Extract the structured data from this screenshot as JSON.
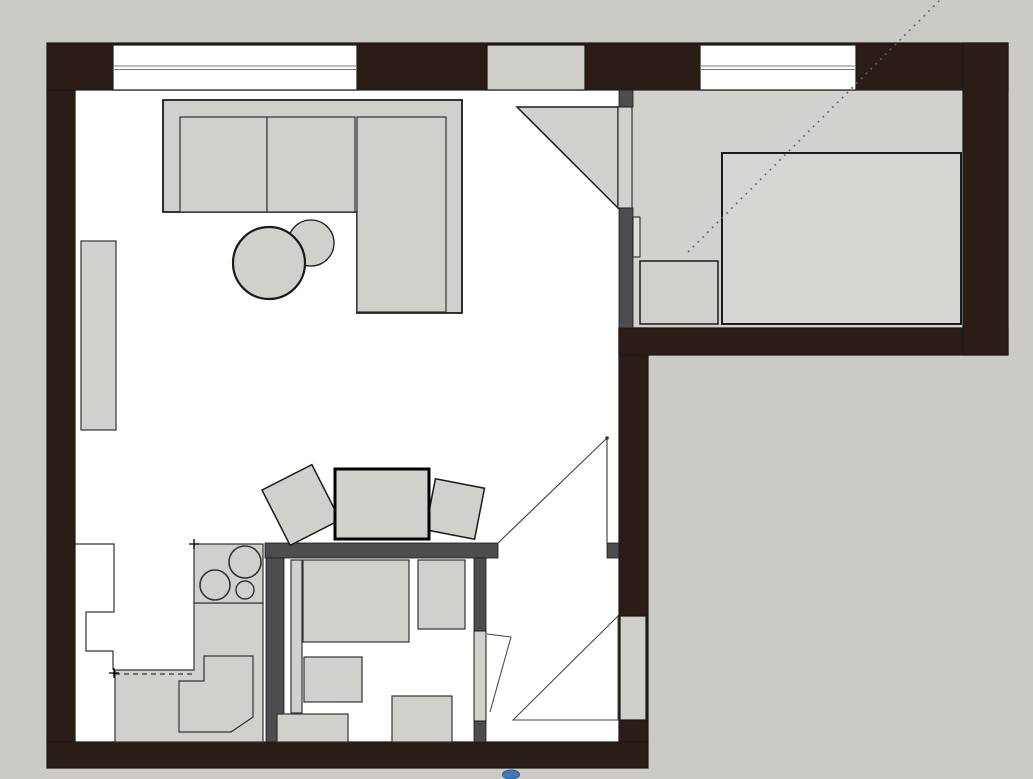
{
  "app": {
    "title": "apartment-floor-plan",
    "canvas": {
      "width": 1033,
      "height": 779
    }
  },
  "palette": {
    "outside": "#cbcac5",
    "floor": "#ffffff",
    "room_gray": "#d2d1cd",
    "furniture": "#d2d0cc",
    "bed": "#d6d5d1",
    "leaf": "#d2d1cd",
    "block": "#d0cfca",
    "fixture": "#dededa",
    "wall": "#2a1d18",
    "partition": "#4d4d4f",
    "line": "#1a1a1a",
    "thin": "#333333",
    "swing": "#4a4a4a",
    "glass_line": "#7a7a7a",
    "dotted": "#5f5f96",
    "black": "#000000",
    "blue": "#4179b5",
    "blue_edge": "#2d5a8a",
    "none": "none"
  },
  "shapes": [
    {
      "name": "outside-ground",
      "type": "rect",
      "x": 0,
      "y": 0,
      "w": 1033,
      "h": 779,
      "fill": "outside"
    },
    {
      "name": "main-floor",
      "type": "rect",
      "x": 75,
      "y": 90,
      "w": 544,
      "h": 652,
      "fill": "floor"
    },
    {
      "name": "bedroom-floor",
      "type": "rect",
      "x": 633,
      "y": 90,
      "w": 330,
      "h": 238,
      "fill": "room_gray"
    },
    {
      "name": "top-exterior-wall",
      "type": "rect",
      "x": 47,
      "y": 43,
      "w": 961,
      "h": 47,
      "fill": "wall",
      "stroke": "line",
      "sw": 1.2
    },
    {
      "name": "left-exterior-wall",
      "type": "rect",
      "x": 47,
      "y": 90,
      "w": 28,
      "h": 652,
      "fill": "wall",
      "stroke": "line",
      "sw": 1.2
    },
    {
      "name": "bottom-exterior-wall",
      "type": "rect",
      "x": 47,
      "y": 742,
      "w": 601,
      "h": 26,
      "fill": "wall",
      "stroke": "line",
      "sw": 1.2
    },
    {
      "name": "hall-right-exterior-wall",
      "type": "rect",
      "x": 619,
      "y": 328,
      "w": 29,
      "h": 414,
      "fill": "wall",
      "stroke": "line",
      "sw": 1.2
    },
    {
      "name": "bedroom-bottom-exterior-wall",
      "type": "rect",
      "x": 619,
      "y": 328,
      "w": 389,
      "h": 27,
      "fill": "wall",
      "stroke": "line",
      "sw": 1.2
    },
    {
      "name": "right-exterior-wall",
      "type": "rect",
      "x": 963,
      "y": 43,
      "w": 45,
      "h": 312,
      "fill": "wall",
      "stroke": "line",
      "sw": 1.2
    },
    {
      "name": "living-room-window",
      "type": "rect",
      "x": 113,
      "y": 45,
      "w": 244,
      "h": 45,
      "fill": "floor",
      "stroke": "line",
      "sw": 1.2
    },
    {
      "name": "living-room-window-glass-line-1",
      "type": "line",
      "x1": 113,
      "y1": 66,
      "x2": 357,
      "y2": 66,
      "stroke": "glass_line",
      "sw": 1
    },
    {
      "name": "living-room-window-glass-line-2",
      "type": "line",
      "x1": 113,
      "y1": 69.5,
      "x2": 357,
      "y2": 69.5,
      "stroke": "glass_line",
      "sw": 1
    },
    {
      "name": "wall-infill-block",
      "type": "rect",
      "x": 487,
      "y": 45,
      "w": 98,
      "h": 45,
      "fill": "block",
      "stroke": "line",
      "sw": 1.2
    },
    {
      "name": "bedroom-window",
      "type": "rect",
      "x": 700,
      "y": 45,
      "w": 156,
      "h": 45,
      "fill": "floor",
      "stroke": "line",
      "sw": 1.2
    },
    {
      "name": "bedroom-window-glass-line-1",
      "type": "line",
      "x1": 700,
      "y1": 66,
      "x2": 856,
      "y2": 66,
      "stroke": "glass_line",
      "sw": 1
    },
    {
      "name": "bedroom-window-glass-line-2",
      "type": "line",
      "x1": 700,
      "y1": 69.5,
      "x2": 856,
      "y2": 69.5,
      "stroke": "glass_line",
      "sw": 1
    },
    {
      "name": "left-wall-joint-line",
      "type": "line",
      "x1": 47,
      "y1": 544,
      "x2": 75,
      "y2": 544,
      "stroke": "line",
      "sw": 1
    },
    {
      "name": "hall-wall-joint-line",
      "type": "line",
      "x1": 619,
      "y1": 355,
      "x2": 648,
      "y2": 355,
      "stroke": "line",
      "sw": 1
    },
    {
      "name": "hall-partition-band",
      "type": "rect",
      "x": 265,
      "y": 543,
      "w": 233,
      "h": 15,
      "fill": "partition",
      "stroke": "line",
      "sw": 0.8
    },
    {
      "name": "hall-opening-stub",
      "type": "rect",
      "x": 607,
      "y": 543,
      "w": 12,
      "h": 15,
      "fill": "partition",
      "stroke": "line",
      "sw": 0.8
    },
    {
      "name": "kitchen-bathroom-partition",
      "type": "rect",
      "x": 266,
      "y": 558,
      "w": 18,
      "h": 184,
      "fill": "partition",
      "stroke": "line",
      "sw": 0.8
    },
    {
      "name": "bathroom-right-wall-upper",
      "type": "rect",
      "x": 474,
      "y": 558,
      "w": 12,
      "h": 73,
      "fill": "partition",
      "stroke": "line",
      "sw": 0.8
    },
    {
      "name": "bathroom-right-wall-stub",
      "type": "rect",
      "x": 474,
      "y": 721,
      "w": 12,
      "h": 21,
      "fill": "partition",
      "stroke": "line",
      "sw": 0.8
    },
    {
      "name": "bedroom-partition-stub",
      "type": "rect",
      "x": 619,
      "y": 90,
      "w": 14,
      "h": 17,
      "fill": "partition",
      "stroke": "line",
      "sw": 0.8
    },
    {
      "name": "bedroom-partition-wall",
      "type": "rect",
      "x": 619,
      "y": 208,
      "w": 14,
      "h": 120,
      "fill": "partition",
      "stroke": "line",
      "sw": 0.8
    },
    {
      "name": "bedroom-door-swing",
      "type": "polygon",
      "points": "517,107 618,107 618,208",
      "fill": "room_gray",
      "stroke": "line",
      "sw": 1.5
    },
    {
      "name": "bedroom-door-leaf",
      "type": "rect",
      "x": 618,
      "y": 107,
      "w": 14,
      "h": 101,
      "fill": "leaf",
      "stroke": "line",
      "sw": 1
    },
    {
      "name": "bedroom-wall-fixture",
      "type": "rect",
      "x": 633,
      "y": 217,
      "w": 7,
      "h": 40,
      "fill": "fixture",
      "stroke": "line",
      "sw": 1
    },
    {
      "name": "bed",
      "type": "rect",
      "x": 722,
      "y": 153,
      "w": 239,
      "h": 171,
      "fill": "bed",
      "stroke": "line",
      "sw": 2
    },
    {
      "name": "nightstand",
      "type": "rect",
      "x": 640,
      "y": 261,
      "w": 78,
      "h": 63,
      "fill": "furniture",
      "stroke": "line",
      "sw": 1.5
    },
    {
      "name": "sofa-frame",
      "type": "polygon",
      "points": "163,100 462,100 462,313 357,313 357,212 163,212",
      "fill": "furniture",
      "stroke": "line",
      "sw": 1.8
    },
    {
      "name": "sofa-cushion-left",
      "type": "rect",
      "x": 180,
      "y": 117,
      "w": 87,
      "h": 95,
      "fill": "furniture",
      "stroke": "thin",
      "sw": 1.2
    },
    {
      "name": "sofa-cushion-right",
      "type": "rect",
      "x": 267,
      "y": 117,
      "w": 88,
      "h": 95,
      "fill": "furniture",
      "stroke": "thin",
      "sw": 1.2
    },
    {
      "name": "sofa-chaise-cushion",
      "type": "rect",
      "x": 357,
      "y": 117,
      "w": 89,
      "h": 195,
      "fill": "furniture",
      "stroke": "thin",
      "sw": 1.2
    },
    {
      "name": "side-table",
      "type": "circle",
      "cx": 311,
      "cy": 243,
      "r": 23,
      "fill": "furniture",
      "stroke": "line",
      "sw": 1.3
    },
    {
      "name": "coffee-table",
      "type": "circle",
      "cx": 269,
      "cy": 263,
      "r": 36,
      "fill": "furniture",
      "stroke": "line",
      "sw": 2.2
    },
    {
      "name": "wall-shelf",
      "type": "rect",
      "x": 81,
      "y": 241,
      "w": 35,
      "h": 189,
      "fill": "furniture",
      "stroke": "thin",
      "sw": 1.2
    },
    {
      "name": "dining-chair-left",
      "type": "rect",
      "x": 273,
      "y": 474,
      "w": 56,
      "h": 62,
      "rot": -27,
      "fill": "furniture",
      "stroke": "line",
      "sw": 1.5
    },
    {
      "name": "dining-chair-right",
      "type": "rect",
      "x": 430,
      "y": 483,
      "w": 50,
      "h": 52,
      "rot": 11,
      "fill": "furniture",
      "stroke": "line",
      "sw": 1.5
    },
    {
      "name": "dining-table",
      "type": "rect",
      "x": 335,
      "y": 469,
      "w": 94,
      "h": 70,
      "fill": "furniture",
      "stroke": "black",
      "sw": 3
    },
    {
      "name": "kitchen-tall-unit-outline",
      "type": "path",
      "d": "M75,544 L114,544 L114,612 L86,612 L86,651 L113,651 L113,670",
      "fill": "none",
      "stroke": "thin",
      "sw": 1.2
    },
    {
      "name": "kitchen-counter",
      "type": "polygon",
      "points": "194,603 263,603 263,742 115,742 115,670 194,670",
      "fill": "furniture",
      "stroke": "thin",
      "sw": 1.2
    },
    {
      "name": "cooktop",
      "type": "rect",
      "x": 194,
      "y": 544,
      "w": 69,
      "h": 59,
      "fill": "furniture",
      "stroke": "thin",
      "sw": 1.2
    },
    {
      "name": "burner-large",
      "type": "circle",
      "cx": 245,
      "cy": 562,
      "r": 16,
      "fill": "furniture",
      "stroke": "thin",
      "sw": 1.6
    },
    {
      "name": "burner-medium",
      "type": "circle",
      "cx": 215,
      "cy": 585,
      "r": 15,
      "fill": "furniture",
      "stroke": "thin",
      "sw": 1.6
    },
    {
      "name": "burner-small",
      "type": "circle",
      "cx": 245,
      "cy": 590,
      "r": 9,
      "fill": "furniture",
      "stroke": "thin",
      "sw": 1.4
    },
    {
      "name": "kitchen-sink-unit",
      "type": "polygon",
      "points": "204,656 253,656 253,717 231,732 179,732 179,681 204,681",
      "fill": "furniture",
      "stroke": "thin",
      "sw": 1.2
    },
    {
      "name": "upper-cabinet-dashed-line",
      "type": "line",
      "x1": 115,
      "y1": 674,
      "x2": 193,
      "y2": 674,
      "stroke": "thin",
      "sw": 1.2,
      "dash": "5 4"
    },
    {
      "name": "reference-cross-left",
      "type": "path",
      "d": "M109,673 L119,673 M114,668 L114,678",
      "fill": "none",
      "stroke": "black",
      "sw": 1.3
    },
    {
      "name": "reference-cross-right",
      "type": "path",
      "d": "M189,544 L199,544 M194,539 L194,549",
      "fill": "none",
      "stroke": "black",
      "sw": 1.3
    },
    {
      "name": "hall-door-swing-hypotenuse",
      "type": "line",
      "x1": 498,
      "y1": 543,
      "x2": 607,
      "y2": 438,
      "stroke": "swing",
      "sw": 1.2
    },
    {
      "name": "hall-door-open-leaf-line",
      "type": "line",
      "x1": 607,
      "y1": 438,
      "x2": 607,
      "y2": 543,
      "stroke": "swing",
      "sw": 1.2
    },
    {
      "name": "hall-door-hinge-dot",
      "type": "circle",
      "cx": 607,
      "cy": 438,
      "r": 1.8,
      "fill": "thin"
    },
    {
      "name": "bathroom-pipe-chase",
      "type": "rect",
      "x": 291,
      "y": 560,
      "w": 11,
      "h": 153,
      "fill": "furniture",
      "stroke": "thin",
      "sw": 1.2
    },
    {
      "name": "washing-machine",
      "type": "rect",
      "x": 303,
      "y": 560,
      "w": 106,
      "h": 82,
      "fill": "furniture",
      "stroke": "thin",
      "sw": 1.2
    },
    {
      "name": "bathroom-cabinet-right",
      "type": "rect",
      "x": 418,
      "y": 560,
      "w": 47,
      "h": 69,
      "fill": "furniture",
      "stroke": "thin",
      "sw": 1.2
    },
    {
      "name": "bathroom-sink",
      "type": "rect",
      "x": 304,
      "y": 657,
      "w": 58,
      "h": 45,
      "fill": "furniture",
      "stroke": "thin",
      "sw": 1.2
    },
    {
      "name": "toilet",
      "type": "rect",
      "x": 392,
      "y": 696,
      "w": 60,
      "h": 46,
      "fill": "furniture",
      "stroke": "thin",
      "sw": 1.2
    },
    {
      "name": "bathroom-cabinet-bottom",
      "type": "rect",
      "x": 277,
      "y": 714,
      "w": 71,
      "h": 28,
      "fill": "furniture",
      "stroke": "thin",
      "sw": 1.2
    },
    {
      "name": "bathroom-door-leaf",
      "type": "rect",
      "x": 474,
      "y": 631,
      "w": 12,
      "h": 90,
      "fill": "leaf",
      "stroke": "line",
      "sw": 1
    },
    {
      "name": "bathroom-door-swing",
      "type": "polyline",
      "points": "487,634 511,637 490,712",
      "fill": "none",
      "stroke": "swing",
      "sw": 1.1
    },
    {
      "name": "entrance-door-leaf",
      "type": "rect",
      "x": 620,
      "y": 616,
      "w": 26,
      "h": 104,
      "fill": "block",
      "stroke": "line",
      "sw": 1.2
    },
    {
      "name": "entrance-door-swing",
      "type": "polygon",
      "points": "513,720 618,616 618,720",
      "fill": "none",
      "stroke": "swing",
      "sw": 1.1
    },
    {
      "name": "sight-dotted-line",
      "type": "line",
      "x1": 688,
      "y1": 252,
      "x2": 940,
      "y2": 0,
      "stroke": "dotted",
      "sw": 1.6,
      "dash": "1.8 5"
    },
    {
      "name": "blue-marker",
      "type": "ellipse",
      "cx": 511,
      "cy": 774.5,
      "rx": 8.5,
      "ry": 4.5,
      "fill": "blue",
      "stroke": "blue_edge",
      "sw": 1
    }
  ]
}
